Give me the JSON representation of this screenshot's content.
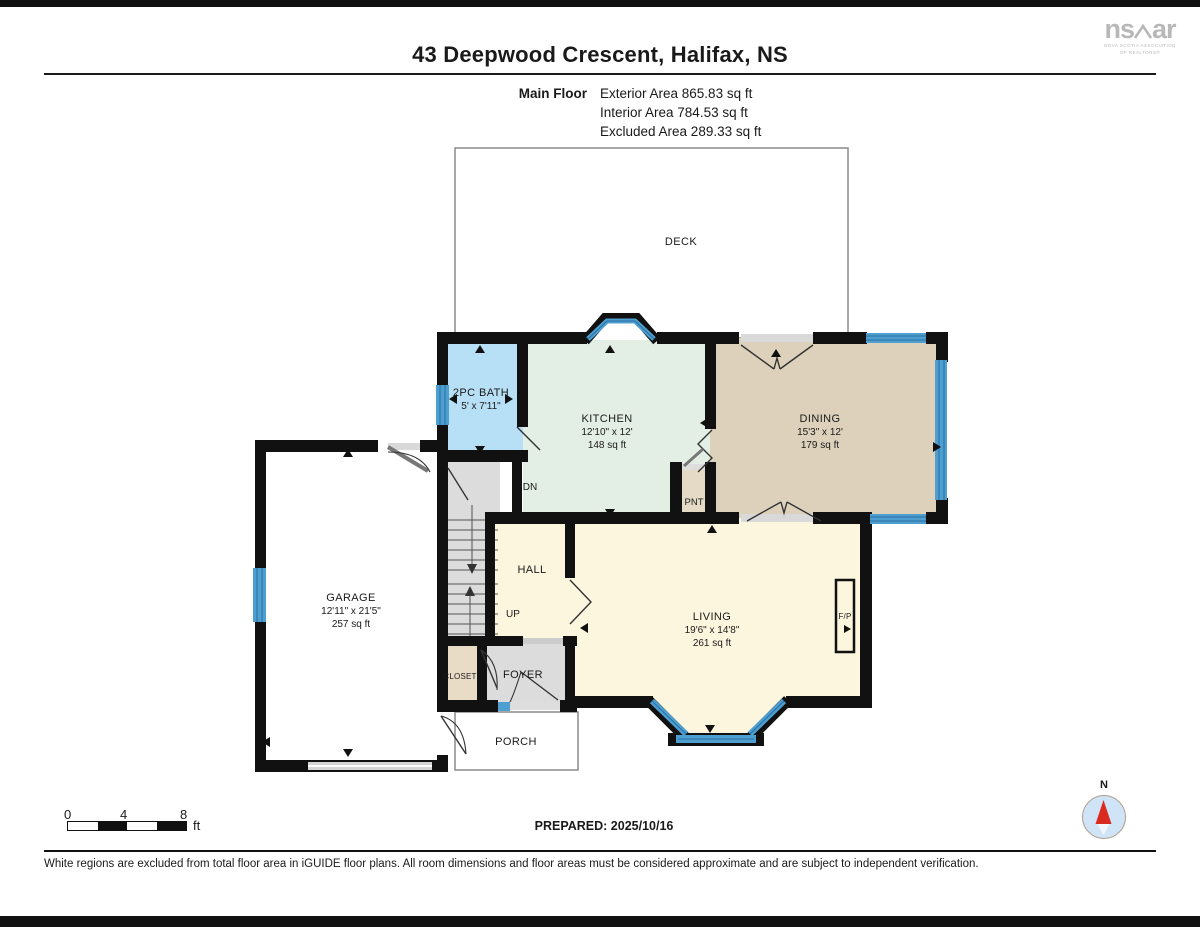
{
  "page": {
    "title": "43 Deepwood Crescent, Halifax, NS"
  },
  "logo": {
    "name_left": "ns",
    "name_right": "ar",
    "subtitle_line1": "NOVA SCOTIA ASSOCIATION",
    "subtitle_line2": "OF REALTORS®"
  },
  "floor_summary": {
    "floor_label": "Main Floor",
    "lines": [
      "Exterior Area 865.83 sq ft",
      "Interior Area 784.53 sq ft",
      "Excluded Area 289.33 sq ft"
    ]
  },
  "rooms": {
    "deck": {
      "name": "DECK"
    },
    "bath": {
      "name": "2PC BATH",
      "dims": "5' x 7'11\""
    },
    "kitchen": {
      "name": "KITCHEN",
      "dims": "12'10\" x 12'",
      "area": "148 sq ft"
    },
    "dining": {
      "name": "DINING",
      "dims": "15'3\" x 12'",
      "area": "179 sq ft"
    },
    "garage": {
      "name": "GARAGE",
      "dims": "12'11\" x 21'5\"",
      "area": "257 sq ft"
    },
    "hall": {
      "name": "HALL"
    },
    "living": {
      "name": "LIVING",
      "dims": "19'6\" x 14'8\"",
      "area": "261 sq ft"
    },
    "pantry": {
      "name": "PNT"
    },
    "closet": {
      "name": "CLOSET"
    },
    "foyer": {
      "name": "FOYER"
    },
    "porch": {
      "name": "PORCH"
    },
    "fireplace": {
      "name": "F/P"
    }
  },
  "stairs": {
    "down": "DN",
    "up": "UP"
  },
  "scale_bar": {
    "ticks": [
      "0",
      "4",
      "8"
    ],
    "unit": "ft"
  },
  "prepared": "PREPARED: 2025/10/16",
  "compass": {
    "north": "N"
  },
  "disclaimer": "White regions are excluded from total floor area in iGUIDE floor plans. All room dimensions and floor areas must be considered approximate and are subject to independent verification.",
  "colors": {
    "wall": "#111111",
    "window_blue": "#4d9fd0",
    "window_stripe": "#2b6ea3",
    "bath_fill": "#b7dff5",
    "kitchen_fill": "#e3efe5",
    "dining_fill": "#ddd1bb",
    "living_fill": "#fdf6de",
    "closet_fill": "#e9dcc7",
    "circulation_gray": "#dcdcdc",
    "compass_red": "#d92b1f"
  }
}
